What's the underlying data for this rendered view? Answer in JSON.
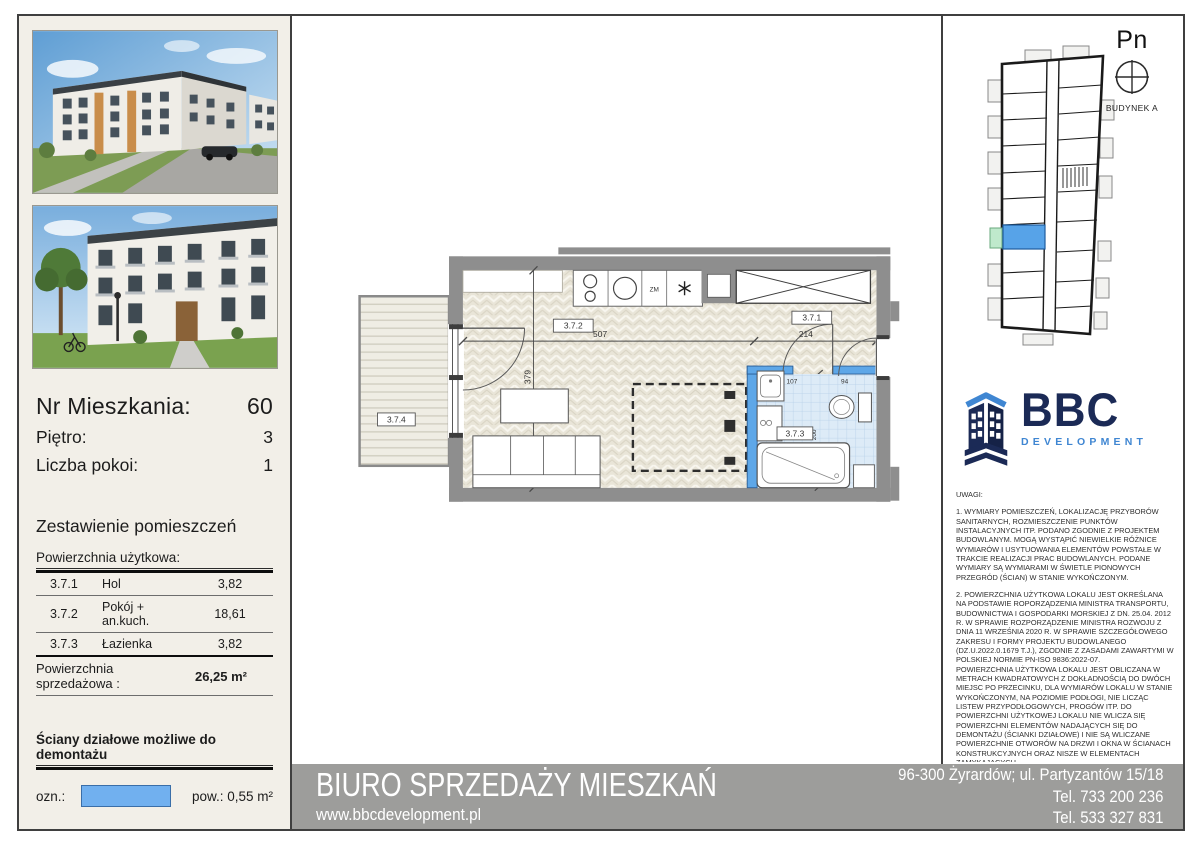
{
  "left": {
    "unit_label": "Nr Mieszkania:",
    "unit_value": "60",
    "floor_label": "Piętro:",
    "floor_value": "3",
    "rooms_label": "Liczba pokoi:",
    "rooms_value": "1",
    "summary_title": "Zestawienie pomieszczeń",
    "usable_area_header": "Powierzchnia użytkowa:",
    "rooms": [
      {
        "id": "3.7.1",
        "name": "Hol",
        "area": "3,82"
      },
      {
        "id": "3.7.2",
        "name": "Pokój + an.kuch.",
        "area": "18,61"
      },
      {
        "id": "3.7.3",
        "name": "Łazienka",
        "area": "3,82"
      }
    ],
    "total_label": "Powierzchnia sprzedażowa :",
    "total_value": "26,25 m²",
    "demountable_header": "Ściany działowe możliwe do demontażu",
    "demountable_ozn": "ozn.:",
    "demountable_area": "pow.: 0,55 m²",
    "swatch_color": "#71b0ef",
    "garden_label": "Ogródek/Balkon:",
    "garden_value": "3,64 m²"
  },
  "plan": {
    "room_labels": {
      "hall": "3.7.1",
      "living": "3.7.2",
      "bath": "3.7.3",
      "balcony": "3.7.4"
    },
    "dimensions": {
      "living_width": "507",
      "living_depth": "379",
      "hall_width": "214",
      "bath_a": "107",
      "bath_b": "94",
      "bath_depth": "200"
    },
    "appliances": {
      "dishwasher": "ZM"
    },
    "colors": {
      "wall": "#8e8e8e",
      "demountable_wall": "#5ea7e8",
      "tile": "#ddebf7"
    }
  },
  "site": {
    "north_label": "Pn",
    "building_label": "BUDYNEK A",
    "unit_highlight_color": "#57a3e8",
    "balcony_highlight_color": "#bfe9cc"
  },
  "logo": {
    "name": "BBC",
    "subtitle": "DEVELOPMENT",
    "navy": "#1b2a56",
    "blue": "#3f86d2"
  },
  "notes": {
    "header": "UWAGI:",
    "p1": "1. WYMIARY POMIESZCZEŃ, LOKALIZACJĘ PRZYBORÓW SANITARNYCH, ROZMIESZCZENIE PUNKTÓW INSTALACYJNYCH ITP. PODANO ZGODNIE Z PROJEKTEM BUDOWLANYM. MOGĄ WYSTĄPIĆ NIEWIELKIE RÓŻNICE WYMIARÓW I USYTUOWANIA ELEMENTÓW POWSTAŁE W TRAKCIE REALIZACJI PRAC BUDOWLANYCH. PODANE WYMIARY SĄ WYMIARAMI W ŚWIETLE PIONOWYCH PRZEGRÓD (ŚCIAN) W STANIE WYKOŃCZONYM.",
    "p2": "2. POWIERZCHNIA UŻYTKOWA LOKALU JEST OKREŚLANA NA PODSTAWIE ROPORZĄDZENIA MINISTRA TRANSPORTU, BUDOWNICTWA I GOSPODARKI MORSKIEJ Z DN. 25.04. 2012 R. W SPRAWIE ROZPORZĄDZENIE MINISTRA ROZWOJU Z DNIA 11 WRZEŚNIA 2020 R. W SPRAWIE SZCZEGÓŁOWEGO ZAKRESU I FORMY PROJEKTU BUDOWLANEGO (DZ.U.2022.0.1679 T.J.), ZGODNIE Z ZASADAMI ZAWARTYMI W POLSKIEJ NORMIE PN-ISO 9836:2022-07.",
    "p2b": "POWIERZCHNIA UŻYTKOWA LOKALU JEST OBLICZANA W METRACH KWADRATOWYCH Z DOKŁADNOŚCIĄ DO DWÓCH MIEJSC PO PRZECINKU, DLA WYMIARÓW LOKALU W STANIE WYKOŃCZONYM, NA POZIOMIE PODŁOGI, NIE LICZĄC LISTEW PRZYPODŁOGOWYCH, PROGÓW ITP. DO POWIERZCHNI UŻYTKOWEJ LOKALU NIE WLICZA SIĘ POWIERZCHNI ELEMENTÓW NADAJĄCYCH SIĘ DO DEMONTAŻU (ŚCIANKI DZIAŁOWE) I NIE SĄ WLICZANE POWIERZCHNIE OTWORÓW NA DRZWI I OKNA W ŚCIANACH KONSTRUKCYJNYCH ORAZ NISZE W ELEMENTACH ZAMYKAJĄCYCH.",
    "p3": "3. PRZEDSTAWIONA NA RZUCIE ARANŻACJA MA CHARAKTER PRZYKŁADOWY, UMEBLOWANIE NIE STANOWI WYPOSAŻENIA NABYWANEGO LOKALU."
  },
  "footer": {
    "office": "BIURO SPRZEDAŻY MIESZKAŃ",
    "website": "www.bbcdevelopment.pl",
    "address": "96-300 Żyrardów; ul. Partyzantów 15/18",
    "phone1": "Tel. 733 200 236",
    "phone2": "Tel. 533 327 831"
  }
}
